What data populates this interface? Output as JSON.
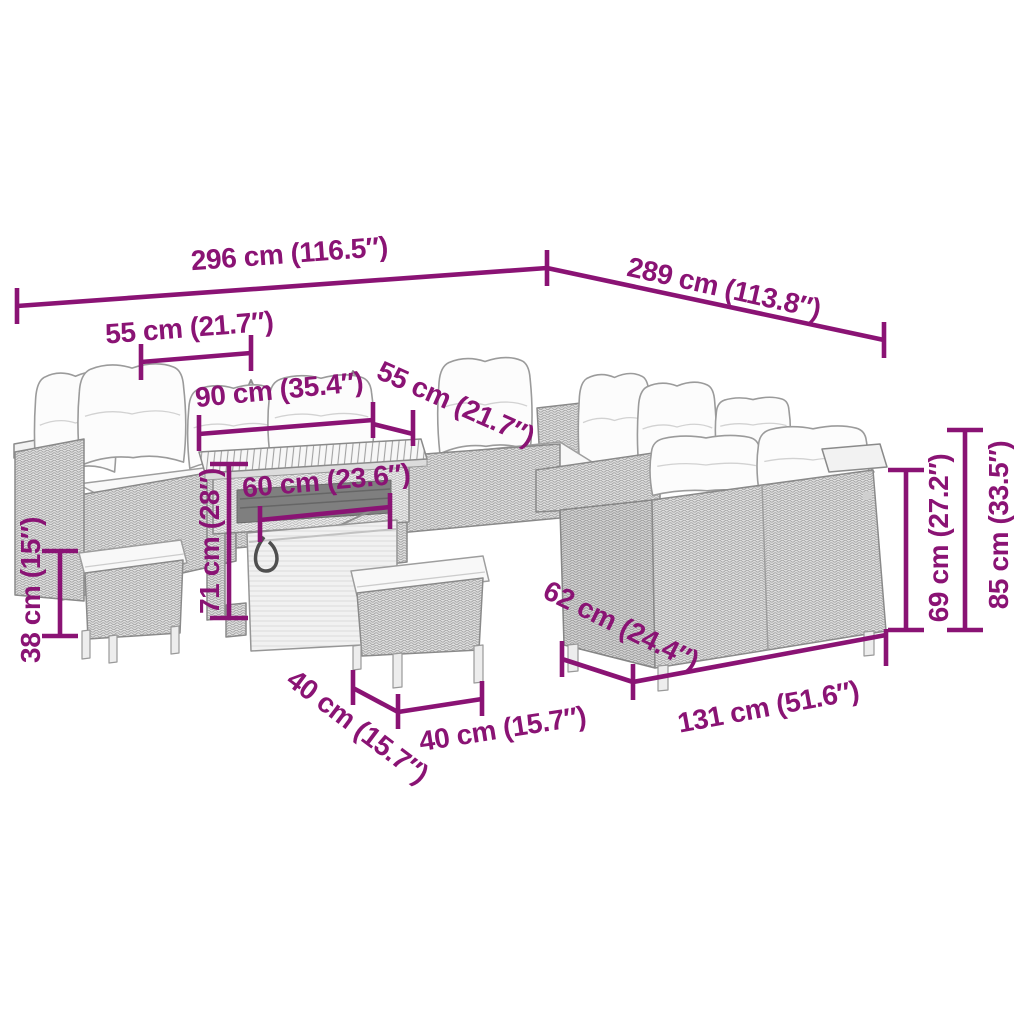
{
  "diagram": {
    "description": "Outdoor poly rattan lounge furniture set line drawing with dimension annotations",
    "background": "#ffffff"
  },
  "style": {
    "dimension_color": "#8A1374",
    "furniture_line_color": "#8a8a8a",
    "rattan_fill": "#dedede",
    "cushion_fill": "#f8f8f8"
  },
  "dims": {
    "total_width_left": {
      "value": "296 cm (116.5″)"
    },
    "total_width_right": {
      "value": "289 cm (113.8″)"
    },
    "left_seat_width": {
      "value": "55 cm (21.7″)"
    },
    "back_span": {
      "value": "90 cm (35.4″)"
    },
    "corner_seat_width": {
      "value": "55 cm (21.7″)"
    },
    "table_width": {
      "value": "60 cm (23.6″)"
    },
    "table_height": {
      "value": "71 cm (28″)"
    },
    "stool_height": {
      "value": "38 cm (15″)"
    },
    "stool_depth": {
      "value": "40 cm (15.7″)"
    },
    "stool_width": {
      "value": "40 cm (15.7″)"
    },
    "sofa_depth": {
      "value": "62 cm (24.4″)"
    },
    "sofa_width": {
      "value": "131 cm (51.6″)"
    },
    "seat_back_height": {
      "value": "69 cm (27.2″)"
    },
    "total_height": {
      "value": "85 cm (33.5″)"
    }
  }
}
